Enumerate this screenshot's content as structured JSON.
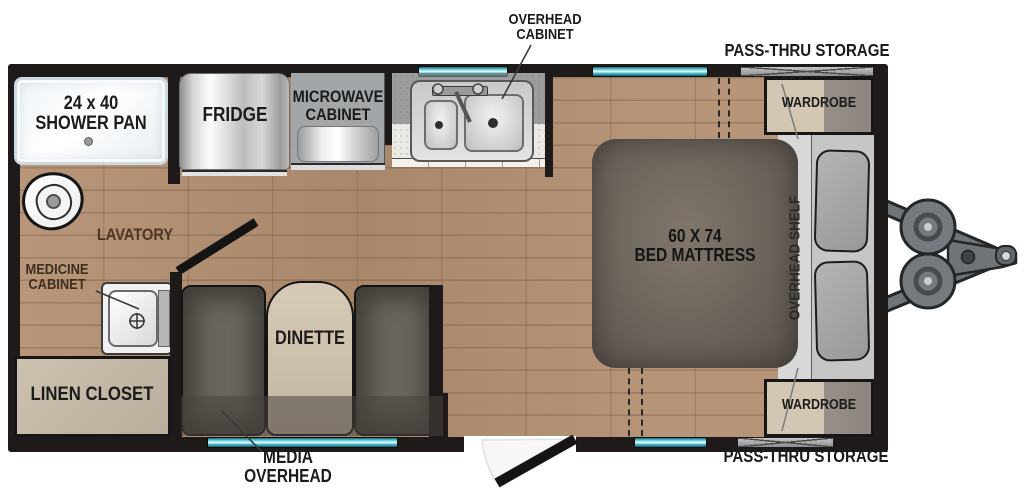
{
  "meta": {
    "type": "rv-floorplan",
    "description": "Travel trailer floor plan, top-down view"
  },
  "colors": {
    "wall": "#1e1a19",
    "floor_wood": "#b28e70",
    "window_teal": "#49b6c6",
    "counter": "#eceae5",
    "mattress": "#6b635b",
    "cabinet_tan": "#d2c7b3",
    "bench_gray": "#6b665e",
    "shelf_gray": "#c6c6c6",
    "hitch_gray": "#70767a",
    "label_text": "#1b1b1b"
  },
  "labels": {
    "overhead_cabinet": "OVERHEAD\nCABINET",
    "pass_thru_storage_top": "PASS-THRU STORAGE",
    "shower_pan": "24 x 40\nSHOWER PAN",
    "fridge": "FRIDGE",
    "microwave_cabinet": "MICROWAVE\nCABINET",
    "wardrobe_top": "WARDROBE",
    "lavatory": "LAVATORY",
    "medicine_cabinet": "MEDICINE\nCABINET",
    "bed_mattress": "60 X 74\nBED MATTRESS",
    "overhead_shelf": "OVERHEAD SHELF",
    "dinette": "DINETTE",
    "linen_closet": "LINEN CLOSET",
    "media_overhead": "MEDIA\nOVERHEAD",
    "wardrobe_bottom": "WARDROBE",
    "pass_thru_storage_bottom": "PASS-THRU STORAGE"
  }
}
